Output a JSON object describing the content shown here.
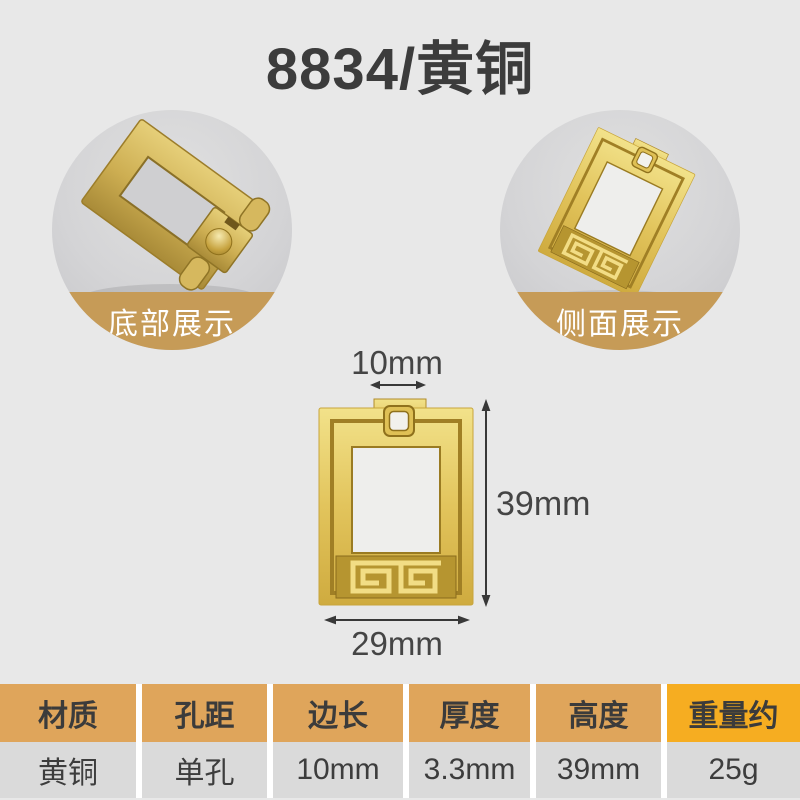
{
  "title": "8834/黄铜",
  "gallery": [
    {
      "label": "底部展示"
    },
    {
      "label": "侧面展示"
    }
  ],
  "diagram": {
    "top_width_label": "10mm",
    "height_label": "39mm",
    "bottom_width_label": "29mm"
  },
  "spec_table": {
    "columns": [
      {
        "header": "材质",
        "value": "黄铜"
      },
      {
        "header": "孔距",
        "value": "单孔"
      },
      {
        "header": "边长",
        "value": "10mm"
      },
      {
        "header": "厚度",
        "value": "3.3mm"
      },
      {
        "header": "高度",
        "value": "39mm"
      },
      {
        "header": "重量约",
        "value": "25g",
        "highlight": true
      }
    ]
  },
  "colors": {
    "page_background": "#e8e8e8",
    "caption_band": "#c69b57",
    "table_header": "#dfa55b",
    "table_header_highlight": "#f6ad21",
    "table_value_background": "#dadada",
    "brass_gold": "#e2c45c",
    "dark_text": "#3c3c3c"
  }
}
